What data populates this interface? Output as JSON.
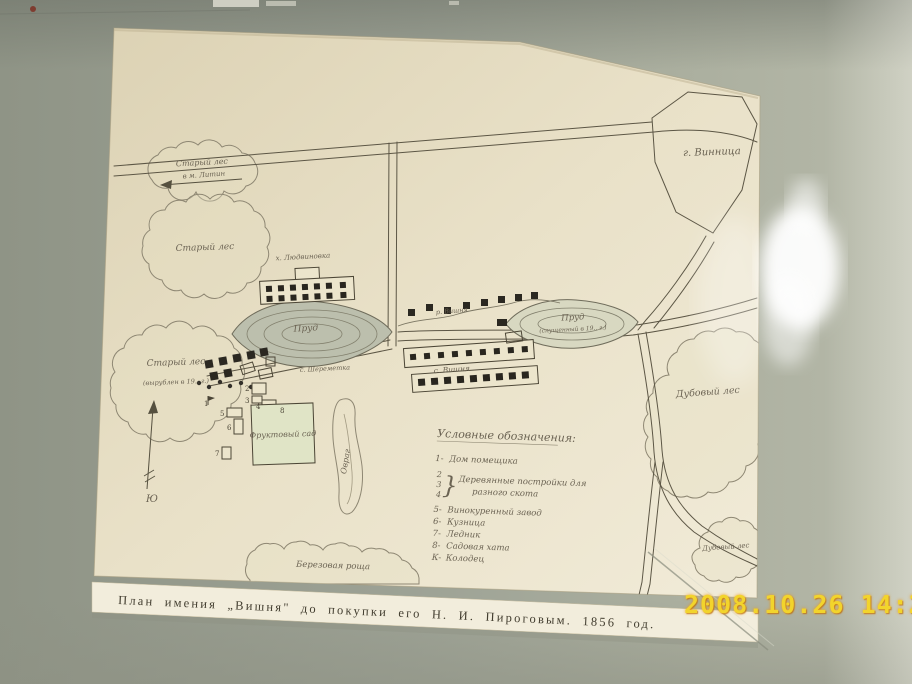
{
  "photo": {
    "timestamp": "2008.10.26 14:24",
    "colors": {
      "wall": "#a2a697",
      "paper": "#e9e1c8",
      "ink": "#55503f",
      "timestamp": "#f2d42c"
    }
  },
  "map": {
    "caption": "План имения „Вишня\" до покупки его Н. И. Пироговым. 1856 год.",
    "labels": {
      "city": "г. Винница",
      "road_to_litin": "в м. Литин",
      "old_forest_top": "Старый лес",
      "old_forest_mid": "Старый лес",
      "old_forest_low": "Старый лес",
      "old_forest_low_note": "(вырублен в 19.. г.)",
      "oak_forest_big": "Дубовый лес",
      "oak_forest_small": "Дубовый лес",
      "birch_grove": "Березовая роща",
      "pond_left": "Пруд",
      "pond_right": "Пруд",
      "pond_right_note": "(спущенный в 19.. г.)",
      "river": "р. Вишня",
      "village": "с. Вишня",
      "village2": "с. Шереметка",
      "hamlet": "х. Людвиновка",
      "orchard": "Фруктовый сад",
      "ravine": "Овраг",
      "south": "Ю"
    },
    "numbers": {
      "n1": "1",
      "n2": "2",
      "n3": "3",
      "n4": "4",
      "n5": "5",
      "n6": "6",
      "n7": "7",
      "n8": "8"
    },
    "legend": {
      "heading": "Условные обозначения:",
      "i1_num": "1-",
      "i1": "Дом помещика",
      "g2": "2",
      "g3": "3",
      "g4": "4",
      "brace": "}",
      "g_line1": "Деревянные постройки для",
      "g_line2": "разного скота",
      "i5_num": "5-",
      "i5": "Винокуренный завод",
      "i6_num": "6-",
      "i6": "Кузница",
      "i7_num": "7-",
      "i7": "Ледник",
      "i8_num": "8-",
      "i8": "Садовая хата",
      "iK_num": "К-",
      "iK": "Колодец"
    }
  }
}
